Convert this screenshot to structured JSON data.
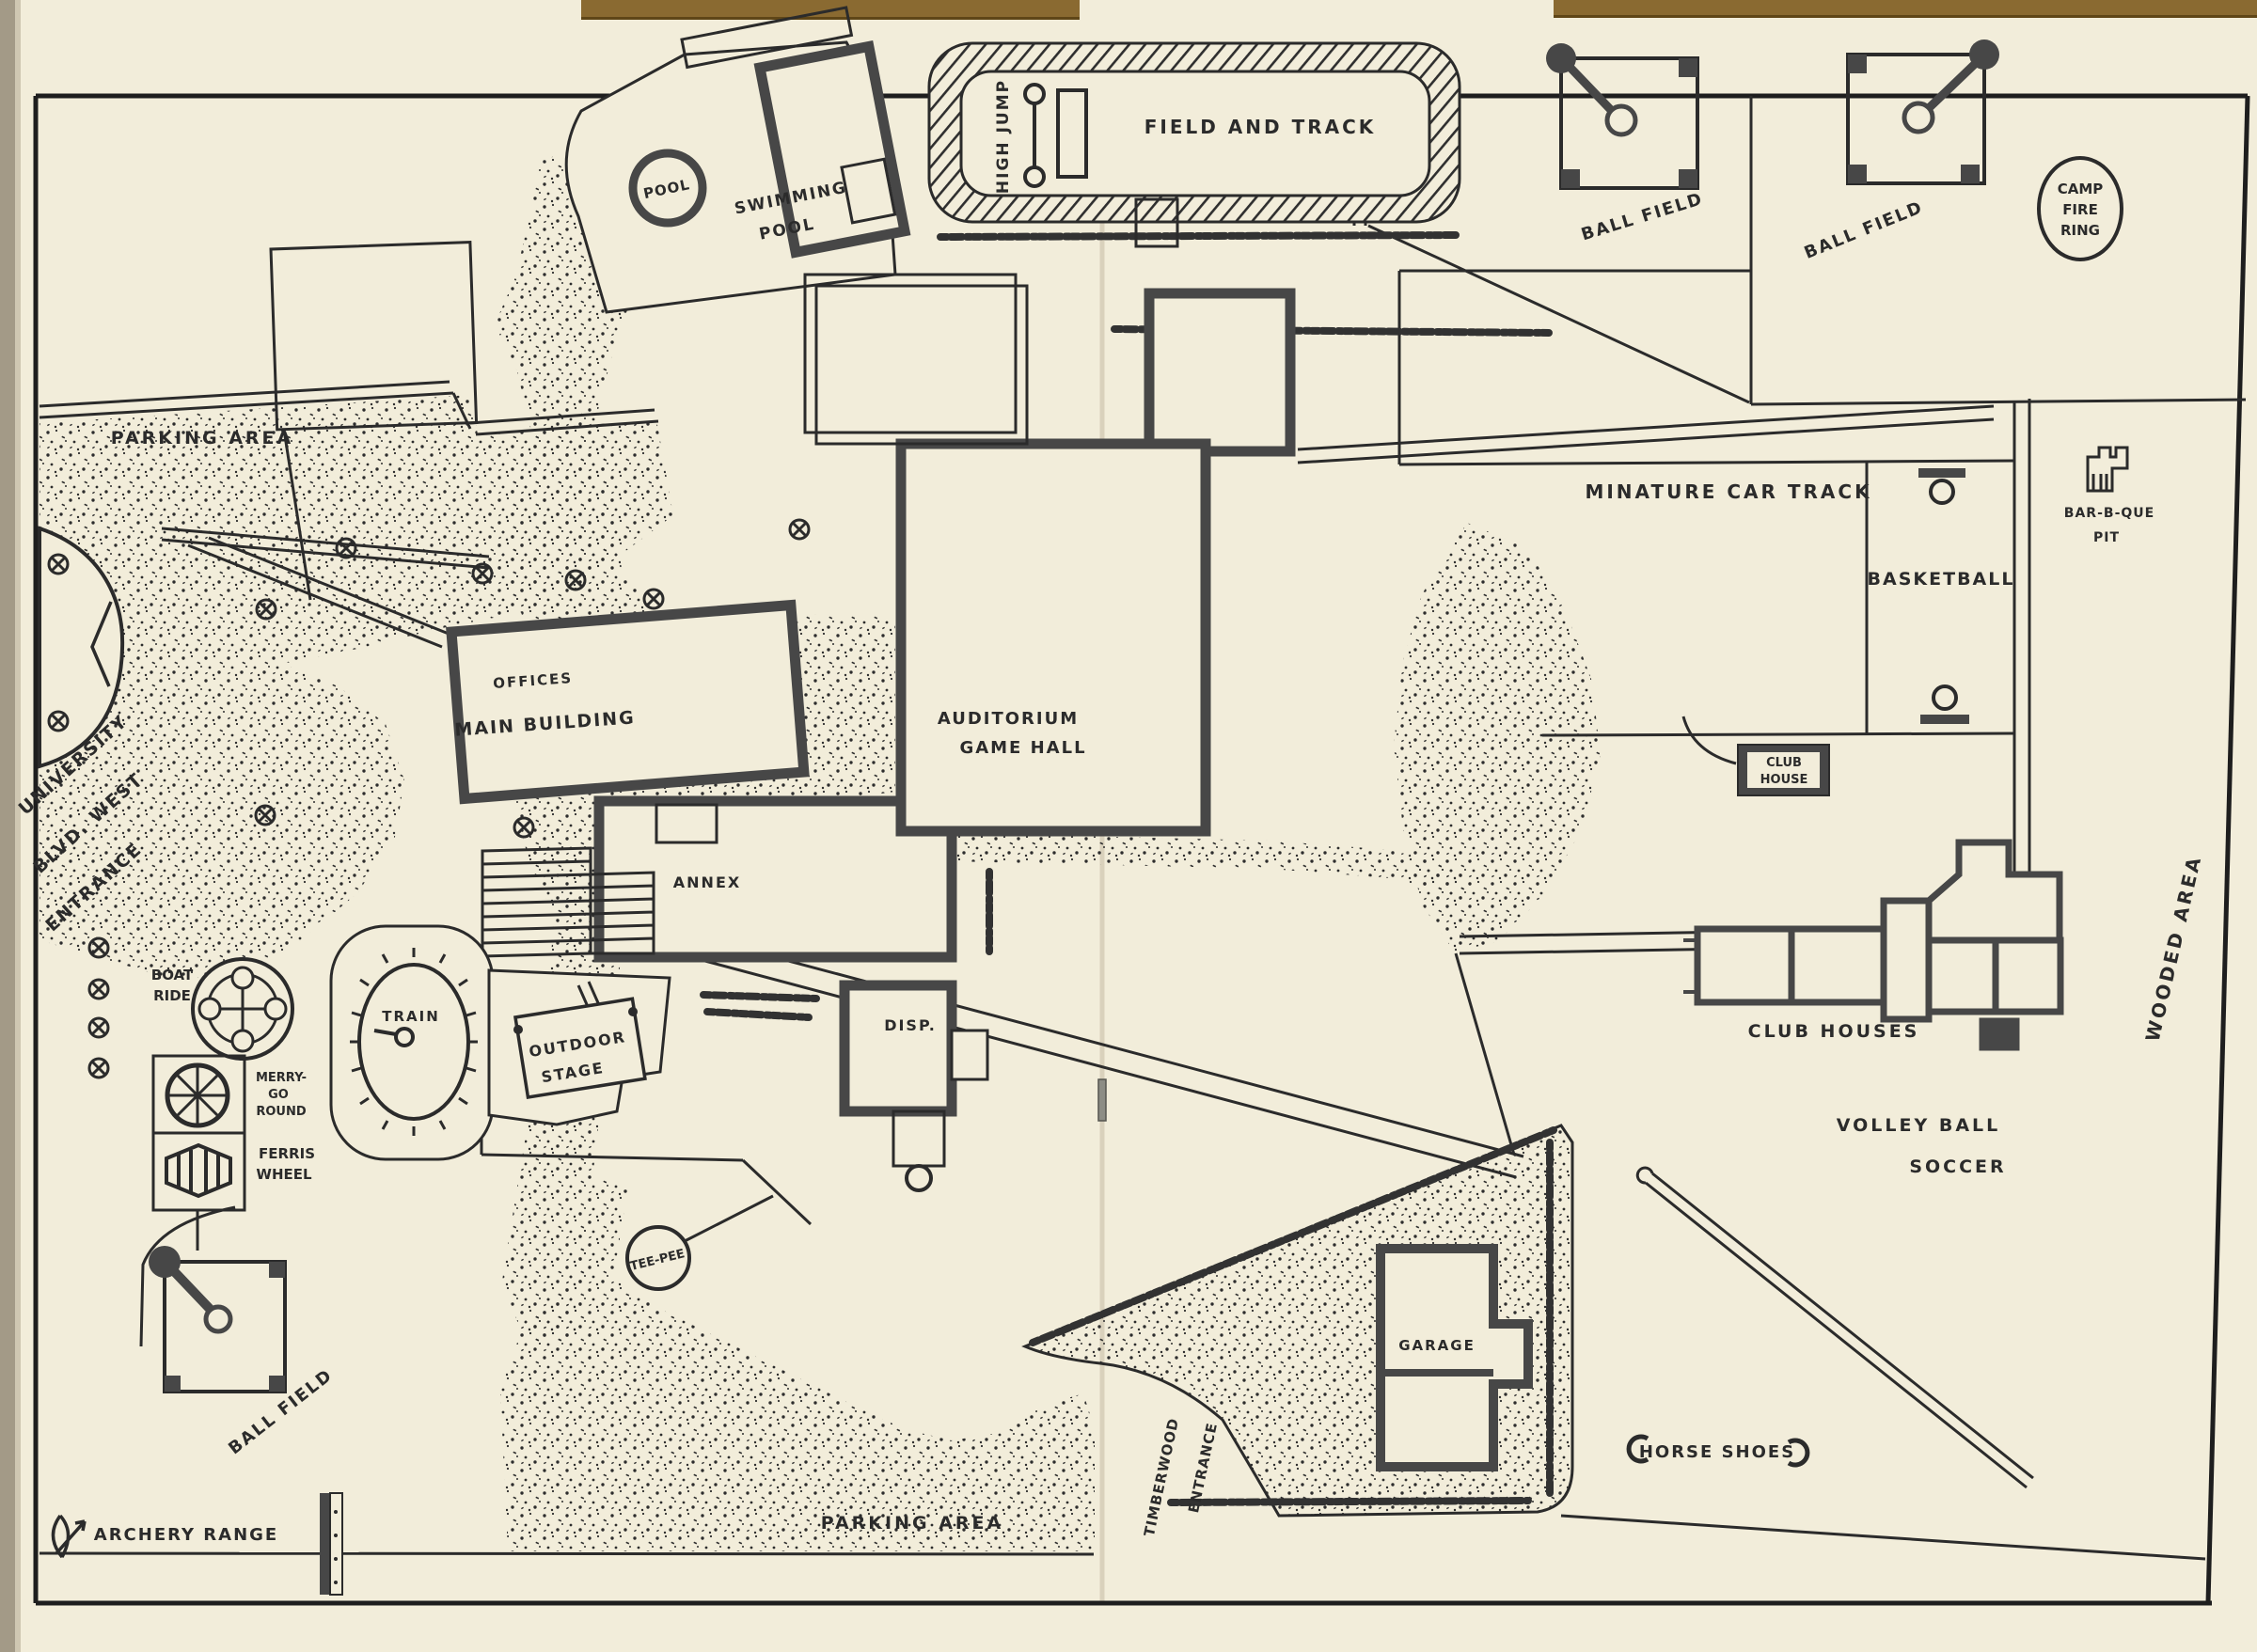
{
  "map_title": "Recreation park facilities map (hand-drawn)",
  "colors": {
    "paper": "#f2edda",
    "ink": "#2b2b2b",
    "wall": "#474747",
    "book_edge": "#8a6a31",
    "side_edge": "#a39a87"
  },
  "labels": {
    "field_and_track": "FIELD AND TRACK",
    "high_jump": "HIGH JUMP",
    "pool": "POOL",
    "swimming_pool": [
      "SWIMMING",
      "POOL"
    ],
    "ball_field_top_1": "BALL FIELD",
    "ball_field_top_2": "BALL FIELD",
    "camp_fire_ring": [
      "CAMP",
      "FIRE",
      "RING"
    ],
    "parking_area_top": "PARKING  AREA",
    "university_entrance": [
      "UNIVERSITY",
      "BLVD. WEST",
      "ENTRANCE"
    ],
    "offices": "OFFICES",
    "main_building": "MAIN BUILDING",
    "annex": "ANNEX",
    "auditorium": [
      "AUDITORIUM",
      "GAME HALL"
    ],
    "disp": "DISP.",
    "boat_ride": [
      "BOAT",
      "RIDE"
    ],
    "train": "TRAIN",
    "merry_go_round": [
      "MERRY-",
      "GO",
      "ROUND"
    ],
    "ferris_wheel": [
      "FERRIS",
      "WHEEL"
    ],
    "outdoor_stage": [
      "OUTDOOR",
      "STAGE"
    ],
    "tee_pee": "TEE-PEE",
    "ball_field_bottom": "BALL FIELD",
    "archery_range": "ARCHERY RANGE",
    "parking_area_bottom": "PARKING  AREA",
    "timberwood_entrance": [
      "TIMBERWOOD",
      "ENTRANCE"
    ],
    "garage": "GARAGE",
    "horse_shoes": "HORSE SHOES",
    "volley_ball": "VOLLEY BALL",
    "soccer": "SOCCER",
    "club_houses": "CLUB HOUSES",
    "club_house": [
      "CLUB",
      "HOUSE"
    ],
    "minature_car_track": "MINATURE  CAR  TRACK",
    "basketball": "BASKETBALL",
    "bar_b_que_pit": [
      "BAR-B-QUE",
      "PIT"
    ],
    "wooded_area": "WOODED  AREA"
  }
}
